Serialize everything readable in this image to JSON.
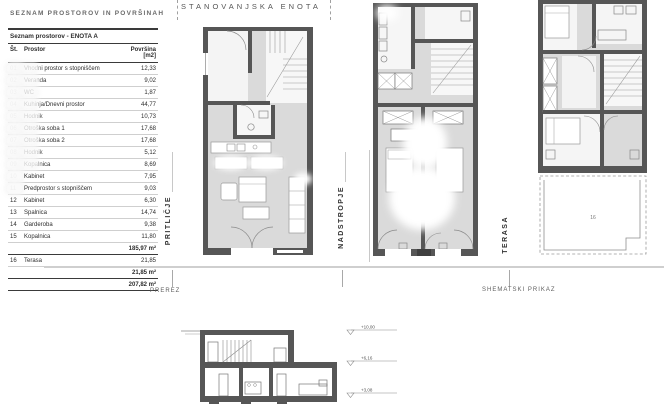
{
  "sheet": {
    "title": "SEZNAM PROSTOROV IN POVRŠINAH",
    "unit_label": "STANOVANJSKA ENOTA",
    "floor_labels": {
      "ground": "PRITLIČJE",
      "upper": "NADSTROPJE",
      "terrace": "TERASA"
    },
    "captions": {
      "section": "PREREZ",
      "schematic": "SHEMATSKI PRIKAZ"
    }
  },
  "table": {
    "title": "Seznam prostorov - ENOTA A",
    "columns": {
      "num": "Št.",
      "name": "Prostor",
      "area": "Površina [m2]"
    },
    "rows": [
      {
        "num": "01",
        "name": "Vhodni prostor s stopniščem",
        "area": "12,33"
      },
      {
        "num": "02",
        "name": "Veranda",
        "area": "9,02"
      },
      {
        "num": "03",
        "name": "WC",
        "area": "1,87"
      },
      {
        "num": "04",
        "name": "Kuhinja/Dnevni prostor",
        "area": "44,77"
      },
      {
        "num": "05",
        "name": "Hodnik",
        "area": "10,73"
      },
      {
        "num": "06",
        "name": "Otroška soba 1",
        "area": "17,68"
      },
      {
        "num": "07",
        "name": "Otroška soba 2",
        "area": "17,68"
      },
      {
        "num": "08",
        "name": "Hodnik",
        "area": "5,12"
      },
      {
        "num": "09",
        "name": "Kopalnica",
        "area": "8,69"
      },
      {
        "num": "10",
        "name": "Kabinet",
        "area": "7,95"
      },
      {
        "num": "11",
        "name": "Predprostor s stopniščem",
        "area": "9,03"
      },
      {
        "num": "12",
        "name": "Kabinet",
        "area": "6,30"
      },
      {
        "num": "13",
        "name": "Spalnica",
        "area": "14,74"
      },
      {
        "num": "14",
        "name": "Garderoba",
        "area": "9,38"
      },
      {
        "num": "15",
        "name": "Kopalnica",
        "area": "11,80"
      },
      {
        "num": "16",
        "name": "Terasa",
        "area": "21,85"
      }
    ],
    "subtotal_interior": "185,97 m²",
    "subtotal_terrace": "21,85 m²",
    "total": "207,82 m²"
  },
  "plans": {
    "terrace_number": "16"
  },
  "section": {
    "levels": [
      "+10,00",
      "+6,16",
      "+3,08"
    ]
  },
  "colors": {
    "wall": "#565656",
    "floor": "#dadada",
    "line": "#999999",
    "rule": "#cfcfcf"
  }
}
